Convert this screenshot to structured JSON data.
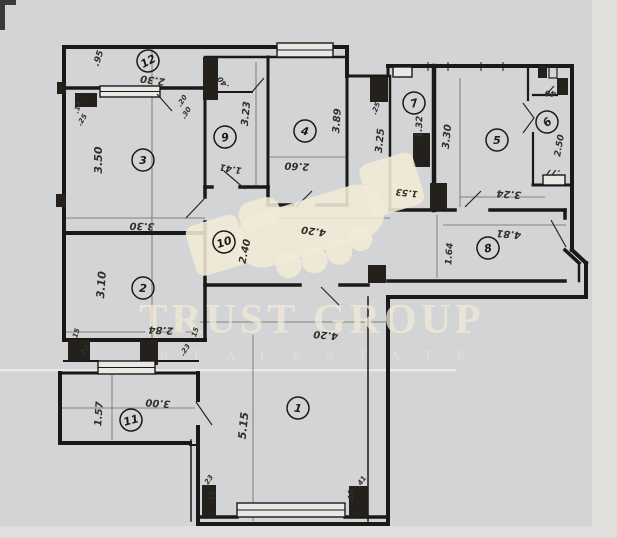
{
  "watermark": {
    "brand": "TRUST GROUP",
    "tagline": "R E A L   E S T A T E",
    "color": "#f1ead6"
  },
  "colors": {
    "paper": "#d3d4d6",
    "paper_margin": "#e2e1de",
    "ink": "#1b1917",
    "dim_ink": "#332f29",
    "watermark_cream": "#f1ead6"
  },
  "plan": {
    "type": "hand-drawn apartment floor plan",
    "room_count_labels": 12
  },
  "rooms": [
    {
      "number": "1",
      "x": 298,
      "y": 408,
      "rot": 8
    },
    {
      "number": "2",
      "x": 143,
      "y": 288,
      "rot": 5
    },
    {
      "number": "3",
      "x": 143,
      "y": 160,
      "rot": 0
    },
    {
      "number": "4",
      "x": 305,
      "y": 131,
      "rot": 10
    },
    {
      "number": "5",
      "x": 497,
      "y": 140,
      "rot": 0
    },
    {
      "number": "6",
      "x": 547,
      "y": 122,
      "rot": -42
    },
    {
      "number": "7",
      "x": 414,
      "y": 103,
      "rot": -15
    },
    {
      "number": "8",
      "x": 488,
      "y": 248,
      "rot": -10
    },
    {
      "number": "9",
      "x": 225,
      "y": 137,
      "rot": -12
    },
    {
      "number": "10",
      "x": 224,
      "y": 242,
      "rot": -18
    },
    {
      "number": "11",
      "x": 131,
      "y": 420,
      "rot": -15
    },
    {
      "number": "12",
      "x": 148,
      "y": 61,
      "rot": -28
    }
  ],
  "dimensions": [
    {
      "text": ".95",
      "x": 101,
      "y": 59,
      "rot": -72,
      "size": 9
    },
    {
      "text": "2.30",
      "x": 153,
      "y": 77,
      "rot": 188,
      "size": 10
    },
    {
      "text": "3.50",
      "x": 102,
      "y": 160,
      "rot": -90,
      "size": 11
    },
    {
      "text": "3.30",
      "x": 142,
      "y": 223,
      "rot": 182,
      "size": 10
    },
    {
      "text": "3.23",
      "x": 249,
      "y": 114,
      "rot": -84,
      "size": 10
    },
    {
      "text": "1.41",
      "x": 231,
      "y": 166,
      "rot": 190,
      "size": 9
    },
    {
      "text": "3.89",
      "x": 340,
      "y": 121,
      "rot": -86,
      "size": 10
    },
    {
      "text": "2.60",
      "x": 297,
      "y": 163,
      "rot": 183,
      "size": 10
    },
    {
      "text": "3.25",
      "x": 383,
      "y": 141,
      "rot": -84,
      "size": 10
    },
    {
      "text": "1.32",
      "x": 422,
      "y": 127,
      "rot": -88,
      "size": 9
    },
    {
      "text": "3.30",
      "x": 450,
      "y": 137,
      "rot": -84,
      "size": 10
    },
    {
      "text": "2.50",
      "x": 562,
      "y": 146,
      "rot": -80,
      "size": 9
    },
    {
      "text": ".40",
      "x": 552,
      "y": 91,
      "rot": 185,
      "size": 8
    },
    {
      "text": ".77",
      "x": 553,
      "y": 170,
      "rot": 182,
      "size": 8
    },
    {
      "text": "3.24",
      "x": 509,
      "y": 191,
      "rot": 184,
      "size": 10
    },
    {
      "text": "1.53",
      "x": 407,
      "y": 190,
      "rot": 186,
      "size": 9
    },
    {
      "text": "4.20",
      "x": 314,
      "y": 228,
      "rot": 188,
      "size": 10
    },
    {
      "text": "2.40",
      "x": 248,
      "y": 252,
      "rot": -78,
      "size": 10
    },
    {
      "text": "4.81",
      "x": 509,
      "y": 231,
      "rot": 185,
      "size": 10
    },
    {
      "text": "1.64",
      "x": 452,
      "y": 254,
      "rot": -86,
      "size": 9
    },
    {
      "text": "3.10",
      "x": 105,
      "y": 285,
      "rot": -86,
      "size": 11
    },
    {
      "text": "2.84",
      "x": 161,
      "y": 327,
      "rot": 183,
      "size": 10
    },
    {
      "text": "4.20",
      "x": 326,
      "y": 332,
      "rot": 185,
      "size": 10
    },
    {
      "text": "1.57",
      "x": 102,
      "y": 414,
      "rot": -86,
      "size": 10
    },
    {
      "text": "3.00",
      "x": 158,
      "y": 400,
      "rot": 184,
      "size": 10
    },
    {
      "text": "5.15",
      "x": 247,
      "y": 426,
      "rot": -84,
      "size": 11
    },
    {
      "text": ".40",
      "x": 225,
      "y": 81,
      "rot": -130,
      "size": 7.5
    },
    {
      "text": ".20",
      "x": 184,
      "y": 102,
      "rot": -58,
      "size": 7
    },
    {
      "text": ".30",
      "x": 188,
      "y": 114,
      "rot": -58,
      "size": 7
    },
    {
      "text": ".14",
      "x": 80,
      "y": 108,
      "rot": -72,
      "size": 7
    },
    {
      "text": ".25",
      "x": 84,
      "y": 121,
      "rot": -58,
      "size": 7
    },
    {
      "text": ".25",
      "x": 378,
      "y": 109,
      "rot": -70,
      "size": 7
    },
    {
      "text": ".15",
      "x": 78,
      "y": 335,
      "rot": -72,
      "size": 7
    },
    {
      "text": ".23",
      "x": 86,
      "y": 352,
      "rot": -55,
      "size": 7
    },
    {
      "text": ".15",
      "x": 197,
      "y": 334,
      "rot": -72,
      "size": 7
    },
    {
      "text": ".23",
      "x": 187,
      "y": 351,
      "rot": -55,
      "size": 7
    },
    {
      "text": ".23",
      "x": 210,
      "y": 482,
      "rot": -55,
      "size": 7
    },
    {
      "text": ".11",
      "x": 214,
      "y": 497,
      "rot": -88,
      "size": 7
    },
    {
      "text": ".10",
      "x": 353,
      "y": 496,
      "rot": -88,
      "size": 7
    },
    {
      "text": ".41",
      "x": 363,
      "y": 483,
      "rot": -55,
      "size": 7
    }
  ]
}
